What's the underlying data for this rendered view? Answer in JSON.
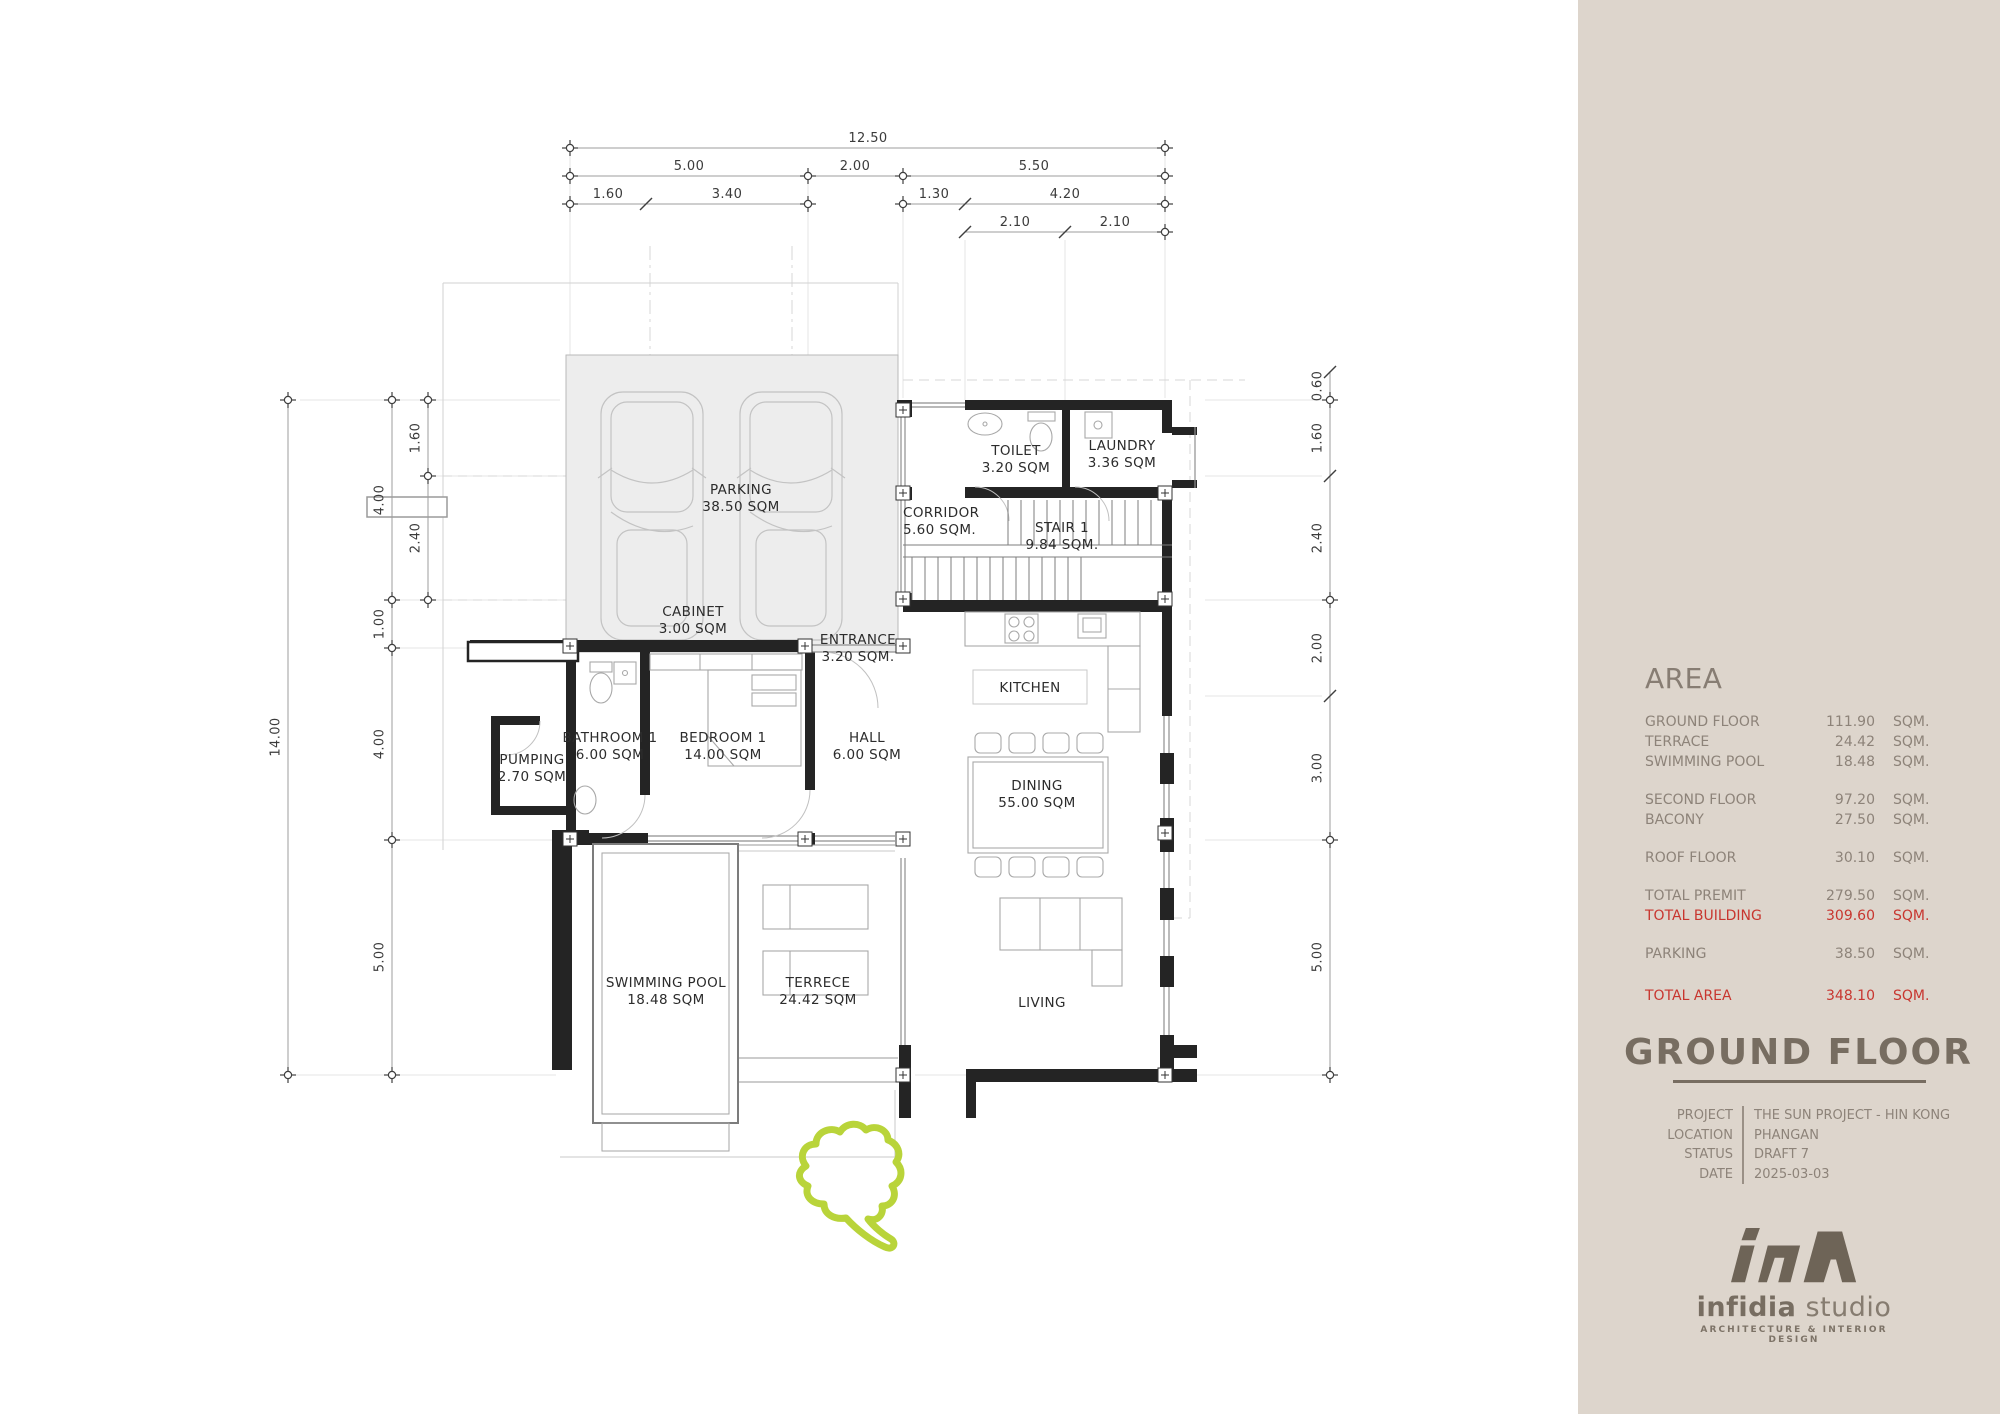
{
  "plan": {
    "dims": {
      "top_total": "12.50",
      "top_a": "5.00",
      "top_b": "2.00",
      "top_c": "5.50",
      "top_a1": "1.60",
      "top_a2": "3.40",
      "top_c1": "1.30",
      "top_c2": "4.20",
      "top_c2a": "2.10",
      "top_c2b": "2.10",
      "left_total": "14.00",
      "left_a": "4.00",
      "left_b": "1.00",
      "left_c": "4.00",
      "left_d": "5.00",
      "left_inner_a": "1.60",
      "left_inner_b": "2.40",
      "right_a": "0.60",
      "right_b": "1.60",
      "right_c": "2.40",
      "right_d": "2.00",
      "right_e": "3.00",
      "right_f": "5.00"
    },
    "rooms": {
      "parking": {
        "name": "PARKING",
        "area": "38.50 SQM"
      },
      "cabinet": {
        "name": "CABINET",
        "area": "3.00 SQM"
      },
      "entrance": {
        "name": "ENTRANCE",
        "area": "3.20 SQM."
      },
      "toilet": {
        "name": "TOILET",
        "area": "3.20 SQM"
      },
      "laundry": {
        "name": "LAUNDRY",
        "area": "3.36 SQM"
      },
      "corridor": {
        "name": "CORRIDOR",
        "area": "5.60 SQM."
      },
      "stair": {
        "name": "STAIR 1",
        "area": "9.84 SQM."
      },
      "kitchen": {
        "name": "KITCHEN"
      },
      "dining": {
        "name": "DINING",
        "area": "55.00 SQM"
      },
      "living": {
        "name": "LIVING"
      },
      "bathroom": {
        "name": "BATHROOM 1",
        "area": "6.00 SQM"
      },
      "bedroom": {
        "name": "BEDROOM 1",
        "area": "14.00 SQM"
      },
      "hall": {
        "name": "HALL",
        "area": "6.00 SQM"
      },
      "pumping": {
        "name": "PUMPING",
        "area": "2.70 SQM"
      },
      "pool": {
        "name": "SWIMMING POOL",
        "area": "18.48 SQM"
      },
      "terrace": {
        "name": "TERRECE",
        "area": "24.42 SQM"
      }
    },
    "accent_green": "#b9d43a"
  },
  "sidebar": {
    "background": "#ddd5cc",
    "area_title": "AREA",
    "unit": "SQM.",
    "rows": [
      {
        "label": "GROUND FLOOR",
        "value": "111.90",
        "unit": "SQM."
      },
      {
        "label": "TERRACE",
        "value": "24.42",
        "unit": "SQM."
      },
      {
        "label": "SWIMMING POOL",
        "value": "18.48",
        "unit": "SQM."
      },
      {
        "label": "SECOND FLOOR",
        "value": "97.20",
        "unit": "SQM."
      },
      {
        "label": "BACONY",
        "value": "27.50",
        "unit": "SQM."
      },
      {
        "label": "ROOF FLOOR",
        "value": "30.10",
        "unit": "SQM."
      },
      {
        "label": "TOTAL PREMIT",
        "value": "279.50",
        "unit": "SQM."
      },
      {
        "label": "TOTAL BUILDING",
        "value": "309.60",
        "unit": "SQM."
      },
      {
        "label": "PARKING",
        "value": "38.50",
        "unit": "SQM."
      },
      {
        "label": "TOTAL AREA",
        "value": "348.10",
        "unit": "SQM."
      }
    ],
    "highlight_color": "#c8362f"
  },
  "title_block": {
    "title": "GROUND FLOOR",
    "fields": [
      {
        "label": "PROJECT",
        "value": "THE SUN PROJECT - HIN KONG"
      },
      {
        "label": "LOCATION",
        "value": "PHANGAN"
      },
      {
        "label": "STATUS",
        "value": "DRAFT 7"
      },
      {
        "label": "DATE",
        "value": "2025-03-03"
      }
    ]
  },
  "logo": {
    "name": "infidia",
    "suffix": "studio",
    "tagline": "ARCHITECTURE & INTERIOR DESIGN"
  }
}
